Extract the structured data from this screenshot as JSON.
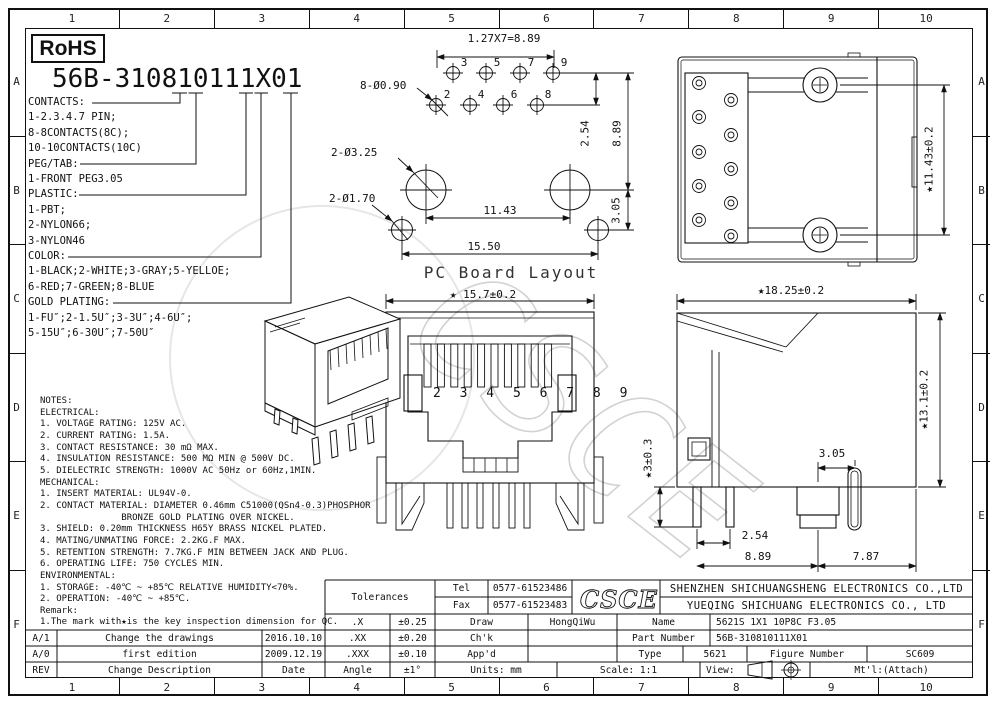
{
  "rohs_label": "RoHS",
  "part_number_heading": "56B-310810111X01",
  "border": {
    "cols": [
      "1",
      "2",
      "3",
      "4",
      "5",
      "6",
      "7",
      "8",
      "9",
      "10"
    ],
    "rows": [
      "A",
      "B",
      "C",
      "D",
      "E",
      "F"
    ]
  },
  "legend": {
    "lines": [
      "CONTACTS:",
      "1-2.3.4.7 PIN;",
      "8-8CONTACTS(8C);",
      "10-10CONTACTS(10C)",
      "PEG/TAB:",
      "1-FRONT PEG3.05",
      "PLASTIC:",
      "1-PBT;",
      "2-NYLON66;",
      "3-NYLON46",
      "COLOR:",
      "1-BLACK;2-WHITE;3-GRAY;5-YELLOE;",
      "6-RED;7-GREEN;8-BLUE",
      "GOLD PLATING:",
      "1-FU″;2-1.5U″;3-3U″;4-6U″;",
      "5-15U″;6-30U″;7-50U″"
    ]
  },
  "notes": {
    "lines": [
      "NOTES:",
      "ELECTRICAL:",
      "1. VOLTAGE RATING: 125V AC.",
      "2. CURRENT RATING: 1.5A.",
      "3. CONTACT RESISTANCE: 30 mΩ MAX.",
      "4. INSULATION RESISTANCE: 500 MΩ MIN @ 500V DC.",
      "5. DIELECTRIC STRENGTH: 1000V AC 50Hz or 60Hz,1MIN.",
      "MECHANICAL:",
      "1. INSERT MATERIAL: UL94V-0.",
      "2. CONTACT MATERIAL: DIAMETER 0.46mm C51000(QSn4-0.3)PHOSPHOR",
      "               BRONZE GOLD PLATING OVER NICKEL.",
      "3. SHIELD: 0.20mm THICKNESS H65Y BRASS NICKEL PLATED.",
      "4. MATING/UNMATING FORCE: 2.2KG.F MAX.",
      "5. RETENTION STRENGTH: 7.7KG.F MIN BETWEEN JACK AND PLUG.",
      "6. OPERATING LIFE: 750 CYCLES MIN.",
      "ENVIRONMENTAL:",
      "1. STORAGE: -40℃ ~ +85℃ RELATIVE HUMIDITY<70%.",
      "2. OPERATION: -40℃ ~ +85℃.",
      "Remark:",
      "1.The mark with★is the key inspection dimension for QC."
    ]
  },
  "pcb": {
    "title": "PC Board Layout",
    "pins_top": [
      "3",
      "5",
      "7",
      "9"
    ],
    "pins_bottom": [
      "2",
      "4",
      "6",
      "8"
    ],
    "dims": {
      "pitch": "1.27X7=8.89",
      "holes": "8-Ø0.90",
      "row_gap": "2.54",
      "span": "8.89",
      "big_holes": "2-Ø3.25",
      "small_holes": "2-Ø1.70",
      "mid": "11.43",
      "offset": "3.05",
      "total": "15.50"
    }
  },
  "views": {
    "top": {
      "height": "★11.43±0.2"
    },
    "side": {
      "width": "★18.25±0.2",
      "height": "★13.1±0.2",
      "leg": "★3±0.3",
      "peg_offset": "3.05",
      "leg_pitch": "2.54",
      "left_span": "8.89",
      "right_span": "7.87"
    },
    "front": {
      "width": "★ 15.7±0.2",
      "pins": "2 3 4 5 6 7 8 9"
    }
  },
  "watermark": "CSCE",
  "title_block": {
    "tolerances_title": "Tolerances",
    "tolerances": [
      [
        ".X",
        "±0.25"
      ],
      [
        ".XX",
        "±0.20"
      ],
      [
        ".XXX",
        "±0.10"
      ],
      [
        "Angle",
        "±1°"
      ]
    ],
    "tel_label": "Tel",
    "tel": "0577-61523486",
    "fax_label": "Fax",
    "fax": "0577-61523483",
    "draw_label": "Draw",
    "draw": "HongQiWu",
    "chk_label": "Ch'k",
    "appd_label": "App'd",
    "units": "Units: mm",
    "scale": "Scale: 1:1",
    "view_label": "View:",
    "mtl": "Mt'l:(Attach)",
    "logo": "CSCE",
    "company_line1": "SHENZHEN SHICHUANGSHENG ELECTRONICS CO.,LTD",
    "company_line2": "YUEQING SHICHUANG ELECTRONICS CO., LTD",
    "name_label": "Name",
    "name": "5621S 1X1 10P8C F3.05",
    "part_number_label": "Part Number",
    "part_number": "56B-310810111X01",
    "type_label": "Type",
    "type": "5621",
    "figure_label": "Figure Number",
    "figure": "SC609",
    "revisions": [
      [
        "A/1",
        "Change the drawings",
        "2016.10.10"
      ],
      [
        "A/0",
        "first edition",
        "2009.12.19"
      ],
      [
        "REV",
        "Change Description",
        "Date"
      ]
    ]
  }
}
